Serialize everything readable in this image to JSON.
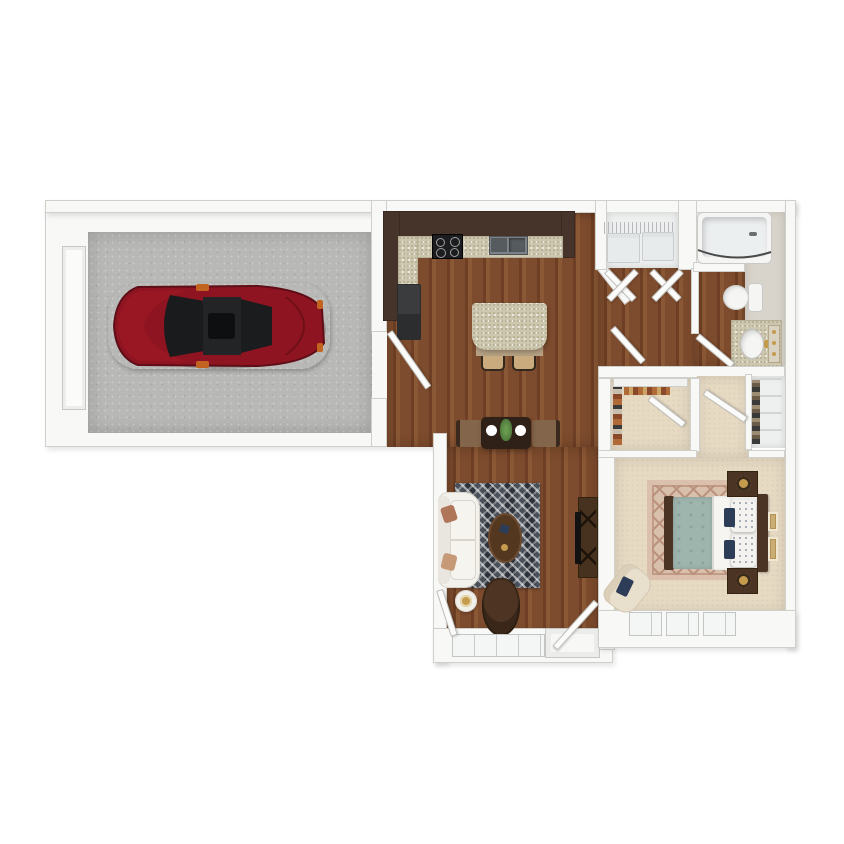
{
  "title": "One-bedroom apartment with attached garage 3D floor plan",
  "palette": {
    "wall": "#f8f8f6",
    "wall_edge": "#cfcfcc",
    "concrete": "#b8b9b7",
    "wood": "#7d4b2d",
    "wood_dark": "#6e3f24",
    "wood_light": "#8b5835",
    "cabinet": "#46332a",
    "cabinet_dark": "#392922",
    "granite": "#cdc7b0",
    "granite_dot": "#b2ab8e",
    "fridge": "#3b3c3e",
    "stove": "#1d1d1f",
    "metal": "#9ba0a3",
    "basin": "#565b5f",
    "island_base": "#b5a183",
    "stool": "#c9ab7e",
    "table": "#2f2118",
    "chair": "#82654a",
    "plate": "#ffffff",
    "plant": "#4f7a3c",
    "rug_dark": "#383d44",
    "rug_light": "#767c84",
    "sofa": "#f3f1ec",
    "sofa_line": "#d9d5cc",
    "pillow": "#b0765a",
    "cocktail": "#53371f",
    "leather": "#4e3423",
    "console": "#46321f",
    "tv": "#121212",
    "carpet": "#e7dac3",
    "bed_rug": "#d9c0ad",
    "bed_rug_line": "#bb927d",
    "duvet": "#9eb5ae",
    "sheet": "#f6f5f2",
    "navy": "#2d3d58",
    "headboard": "#4b3423",
    "gold": "#c59b4d",
    "cream": "#e9dfcd",
    "tub": "#eceff0",
    "fixture": "#f5f5f3",
    "greige": "#d9d4cb",
    "rod": "#4a4a4a",
    "door": "#fbfbf9",
    "window": "#f4f6f5",
    "laundry": "#eef0f0",
    "machine": "#e8ebec",
    "car": "#8d1420",
    "car_dark": "#5f0d16",
    "car_glass": "#1a1b1d",
    "car_orange": "#c2641f",
    "closet_item1": "#b06a38",
    "closet_item2": "#8a4a2a",
    "closet_item3": "#3a3a3a",
    "frame": "#c9ad72"
  },
  "scene": {
    "rooms": [
      {
        "name": "garage",
        "floor": "concrete",
        "contents": [
          "red-sedan-car",
          "garage-door"
        ]
      },
      {
        "name": "kitchen",
        "floor": "wood",
        "contents": [
          "l-shaped-counter",
          "range-stove",
          "double-sink",
          "refrigerator",
          "island-with-two-stools"
        ]
      },
      {
        "name": "dining-area",
        "floor": "wood",
        "contents": [
          "dining-table",
          "two-chairs",
          "two-place-settings",
          "plant-centerpiece"
        ]
      },
      {
        "name": "living-room",
        "floor": "wood",
        "contents": [
          "white-sofa",
          "chevron-rug",
          "oval-coffee-table",
          "accent-chair",
          "side-table-lamp",
          "tv-console",
          "entry-door",
          "windows"
        ]
      },
      {
        "name": "laundry-closet",
        "floor": "vinyl",
        "contents": [
          "washer",
          "dryer",
          "wire-shelf",
          "bifold-doors"
        ]
      },
      {
        "name": "bathroom",
        "floor": "wood-and-greige",
        "contents": [
          "bathtub-shower",
          "toilet",
          "vanity-sink",
          "mirror"
        ]
      },
      {
        "name": "walk-in-closet",
        "floor": "carpet",
        "contents": [
          "hanging-clothes",
          "shelf",
          "door"
        ]
      },
      {
        "name": "linen-closet",
        "floor": "white",
        "contents": [
          "shelves"
        ]
      },
      {
        "name": "bedroom",
        "floor": "carpet",
        "contents": [
          "queen-bed-teal-duvet",
          "two-nightstands-with-lamps",
          "diamond-pattern-rug",
          "cream-armchair",
          "wall-frames",
          "three-windows"
        ]
      }
    ]
  }
}
